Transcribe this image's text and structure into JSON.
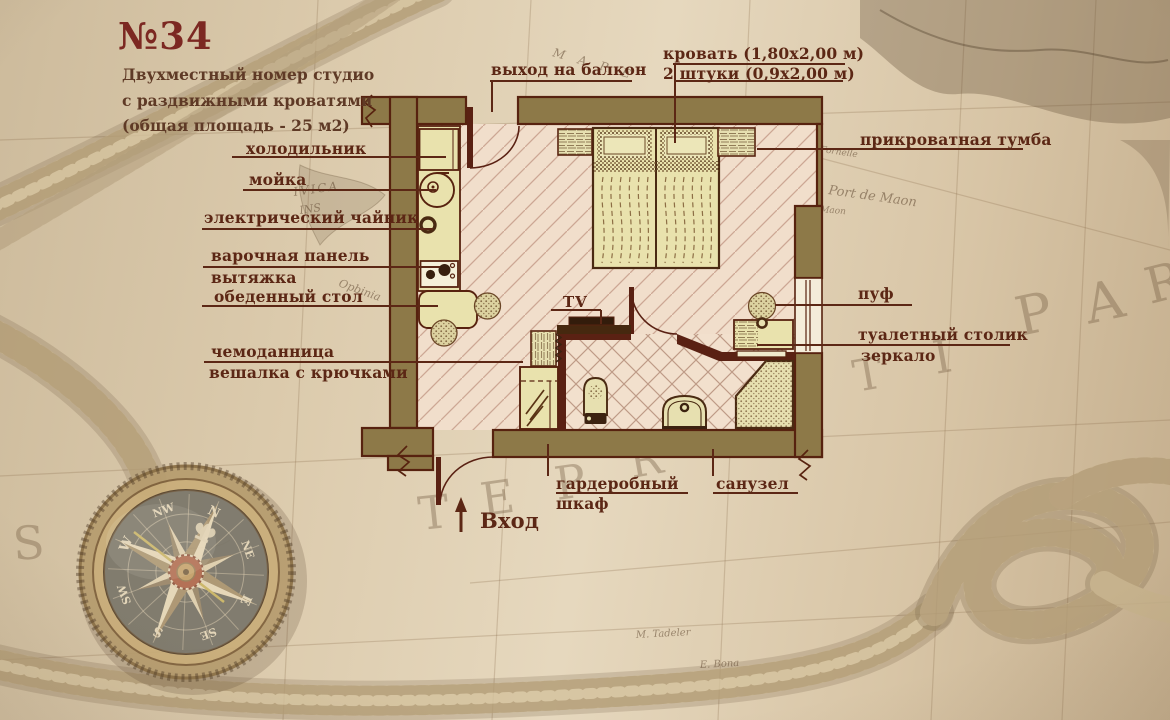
{
  "room": {
    "title": "№34",
    "subtitle1": "Двухместный номер студио",
    "subtitle2": "с раздвижными кроватями",
    "subtitle3": "(общая площадь - 25 м2)"
  },
  "callouts": {
    "fridge": "холодильник",
    "sink": "мойка",
    "kettle": "электрический чайник",
    "hob": "варочная панель",
    "hood": "вытяжка",
    "dining_table": "обеденный стол",
    "luggage": "чемоданница",
    "hooks": "вешалка с крючками",
    "balcony_exit": "выход на балкон",
    "bed_size": "кровать (1,80х2,00 м)",
    "bed_qty": "2 штуки (0,9х2,00 м)",
    "nightstand": "прикроватная тумба",
    "pouf": "пуф",
    "vanity": "туалетный столик",
    "mirror": "зеркало",
    "wardrobe_1": "гардеробный",
    "wardrobe_2": "шкаф",
    "bathroom": "санузел",
    "tv": "TV",
    "entrance": "Вход"
  },
  "map": {
    "big_letters": [
      "S",
      "Т",
      "Е",
      "Р",
      "R",
      "Т",
      "І",
      "Р",
      "А",
      "R"
    ],
    "small_labels": [
      "M A R E",
      "Port de Maon",
      "Fornelle",
      "Maon",
      "IVICA",
      "INS",
      "Opbinia",
      "M. Tadeler",
      "E. Bona"
    ]
  },
  "compass": {
    "directions": [
      "N",
      "NE",
      "E",
      "SE",
      "S",
      "SW",
      "W",
      "NW"
    ]
  },
  "colors": {
    "wall": "#8d7948",
    "wall_outline": "#57220f",
    "floor": "#f1decb",
    "furniture": "#e9e2ad",
    "label_text": "#5c2715",
    "title_text": "#7c2822",
    "paper": "#d9c8ab"
  }
}
